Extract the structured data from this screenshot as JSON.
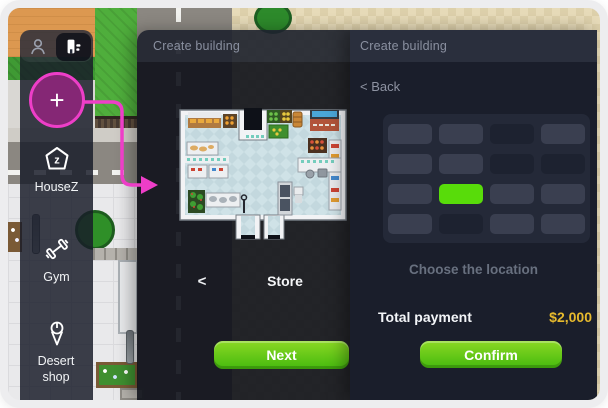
{
  "colors": {
    "magenta": "#ee3ec8",
    "gold": "#e7ba2d",
    "btn-top": "#8bd824",
    "btn-bottom": "#45ba0e",
    "grid-selected": "#58dc0a",
    "cell-light": "#3a3f50",
    "cell-dark": "#1d2230",
    "panel-bg": "#1a1e2b",
    "header-bg": "#2a2f3d"
  },
  "sidebar": {
    "add_button": "+",
    "items": [
      {
        "label": "HouseZ"
      },
      {
        "label": "Gym"
      },
      {
        "label": "Desert shop"
      }
    ]
  },
  "building_panel": {
    "header": "Create building",
    "back_chevron": "<",
    "building_name": "Store",
    "next_label": "Next"
  },
  "location_panel": {
    "header": "Create building",
    "back_label": "< Back",
    "hint": "Choose the location",
    "total_label": "Total payment",
    "total_value": "$2,000",
    "confirm_label": "Confirm",
    "grid": {
      "rows": 4,
      "cols": 4,
      "cells": [
        [
          "light",
          "light",
          "dark",
          "light"
        ],
        [
          "light",
          "light",
          "dark",
          "dark"
        ],
        [
          "light",
          "selected",
          "light",
          "light"
        ],
        [
          "light",
          "dark",
          "light",
          "light"
        ]
      ],
      "selected_cell": {
        "row": 3,
        "col": 2
      }
    }
  }
}
